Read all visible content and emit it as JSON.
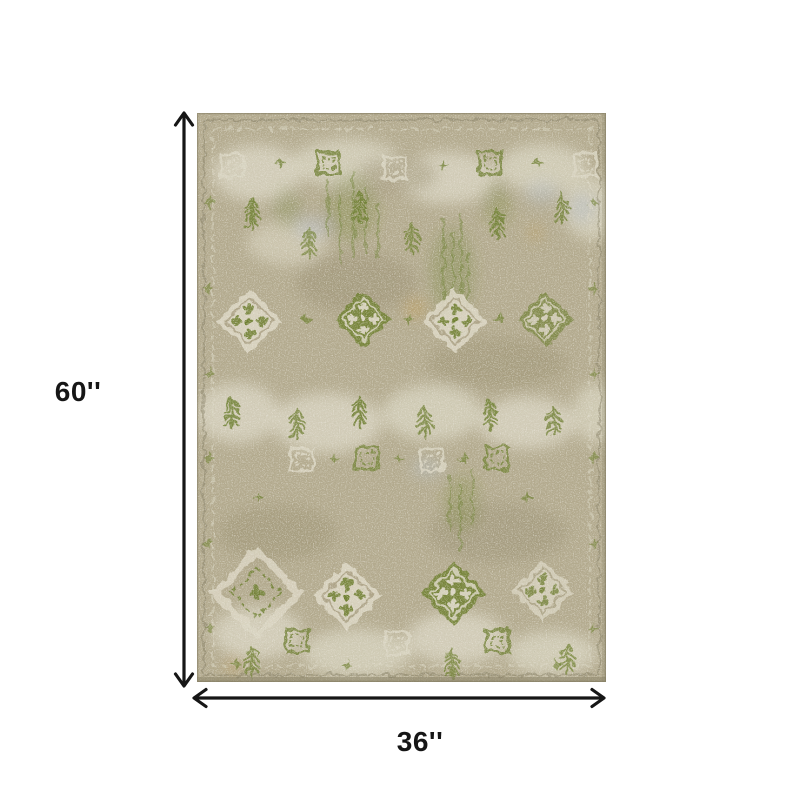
{
  "diagram": {
    "height_label": "60''",
    "width_label": "36''",
    "rug_alt": "distressed green and ivory oriental area rug"
  },
  "theme": {
    "background": "#ffffff",
    "arrow_color": "#161616",
    "label_color": "#161616",
    "rug_base": "#b3aa8e",
    "rug_tan_dark": "#a2987b",
    "rug_cream": "#dad5c2",
    "rug_green": "#708033",
    "rug_green_dark": "#55682a",
    "rug_gold": "#bf9a52",
    "rug_blue_gray": "#b7bec6",
    "rug_shadow": "#80795f"
  }
}
